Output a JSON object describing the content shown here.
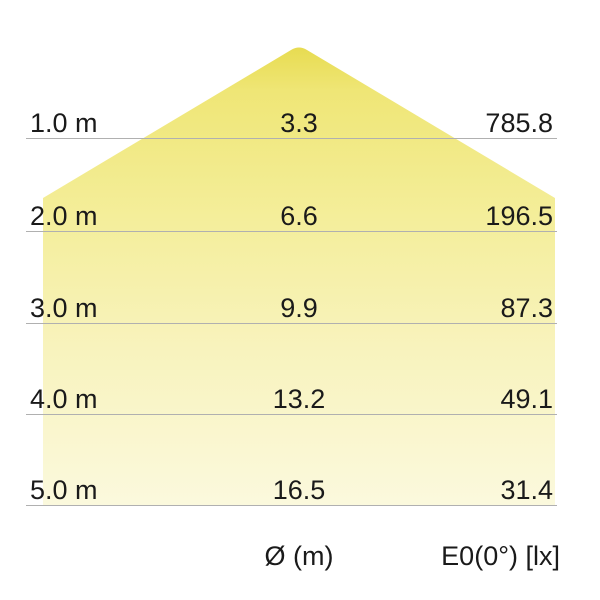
{
  "diagram": {
    "kind": "luminaire-light-distribution-cone",
    "rows": [
      {
        "distance": "1.0 m",
        "diameter_m": "3.3",
        "illuminance_lx": "785.8"
      },
      {
        "distance": "2.0 m",
        "diameter_m": "6.6",
        "illuminance_lx": "196.5"
      },
      {
        "distance": "3.0 m",
        "diameter_m": "9.9",
        "illuminance_lx": "87.3"
      },
      {
        "distance": "4.0 m",
        "diameter_m": "13.2",
        "illuminance_lx": "49.1"
      },
      {
        "distance": "5.0 m",
        "diameter_m": "16.5",
        "illuminance_lx": "31.4"
      }
    ],
    "footer": {
      "diameter_label": "Ø (m)",
      "illuminance_label": "E0(0°) [lx]"
    },
    "colors": {
      "cone_top": "#e7db4f",
      "cone_upper": "#efe676",
      "cone_mid": "#f4ee9b",
      "cone_lower": "#f8f3bd",
      "cone_bottom": "#fbf9dd",
      "grid_line": "#b0b0b0",
      "text": "#1a1a1a"
    }
  },
  "chart_data": {
    "type": "table",
    "title": "Light distribution cone",
    "columns": [
      "distance",
      "beam diameter Ø (m)",
      "E0(0°) [lx]"
    ],
    "categories": [
      "1.0 m",
      "2.0 m",
      "3.0 m",
      "4.0 m",
      "5.0 m"
    ],
    "series": [
      {
        "name": "Ø (m)",
        "values": [
          3.3,
          6.6,
          9.9,
          13.2,
          16.5
        ]
      },
      {
        "name": "E0(0°) [lx]",
        "values": [
          785.8,
          196.5,
          87.3,
          49.1,
          31.4
        ]
      }
    ],
    "legend_position": "none",
    "grid": "horizontal-lines"
  }
}
